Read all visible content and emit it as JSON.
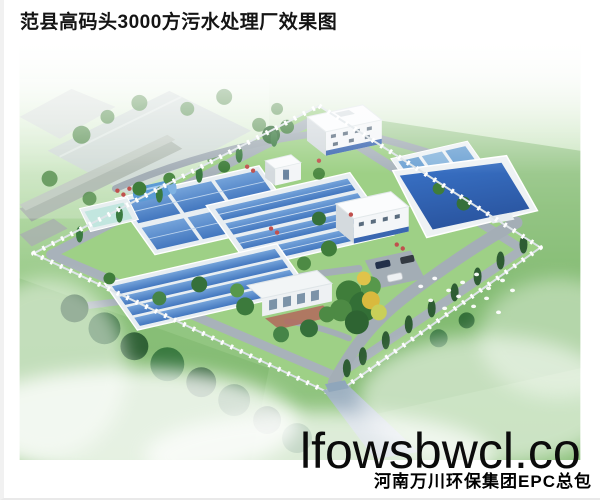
{
  "page": {
    "title": "范县高码头3000方污水处理厂效果图"
  },
  "watermark": {
    "text": "lfowsbwcl.co"
  },
  "footer": {
    "company": "河南万川环保集团EPC总包"
  },
  "scene": {
    "description": "鸟瞰效果图：围墙内的污水处理厂，含曝气池、沉淀池、蓄水池、办公楼、车间、门卫房、道路、绿化树木、草地与薄雾",
    "features": [
      "fenced-plant-compound",
      "aeration-basins",
      "clarifier-basins",
      "small-tank-cluster",
      "storage-pond",
      "side-pool",
      "blue-cylinder-tank",
      "office-building",
      "workshop-building",
      "gate-house",
      "parking-cars",
      "entrance-road",
      "tree-rows",
      "flower-beds",
      "warehouse-roofs",
      "sheep-dots",
      "mist"
    ],
    "colors": {
      "pond_water": "#2e5fae",
      "basin_water": "#5588cc",
      "lawn": "#9ed086",
      "field_green": "#8cc17b",
      "road_gray": "#a3adb5",
      "entrance_road": "#9fb2c2",
      "building_white": "#fafbfc",
      "building_blue_band": "#3a66b0",
      "tree_green": "#2e6432",
      "autumn_tree": "#d9b93e",
      "fence_white": "#ffffff"
    }
  }
}
